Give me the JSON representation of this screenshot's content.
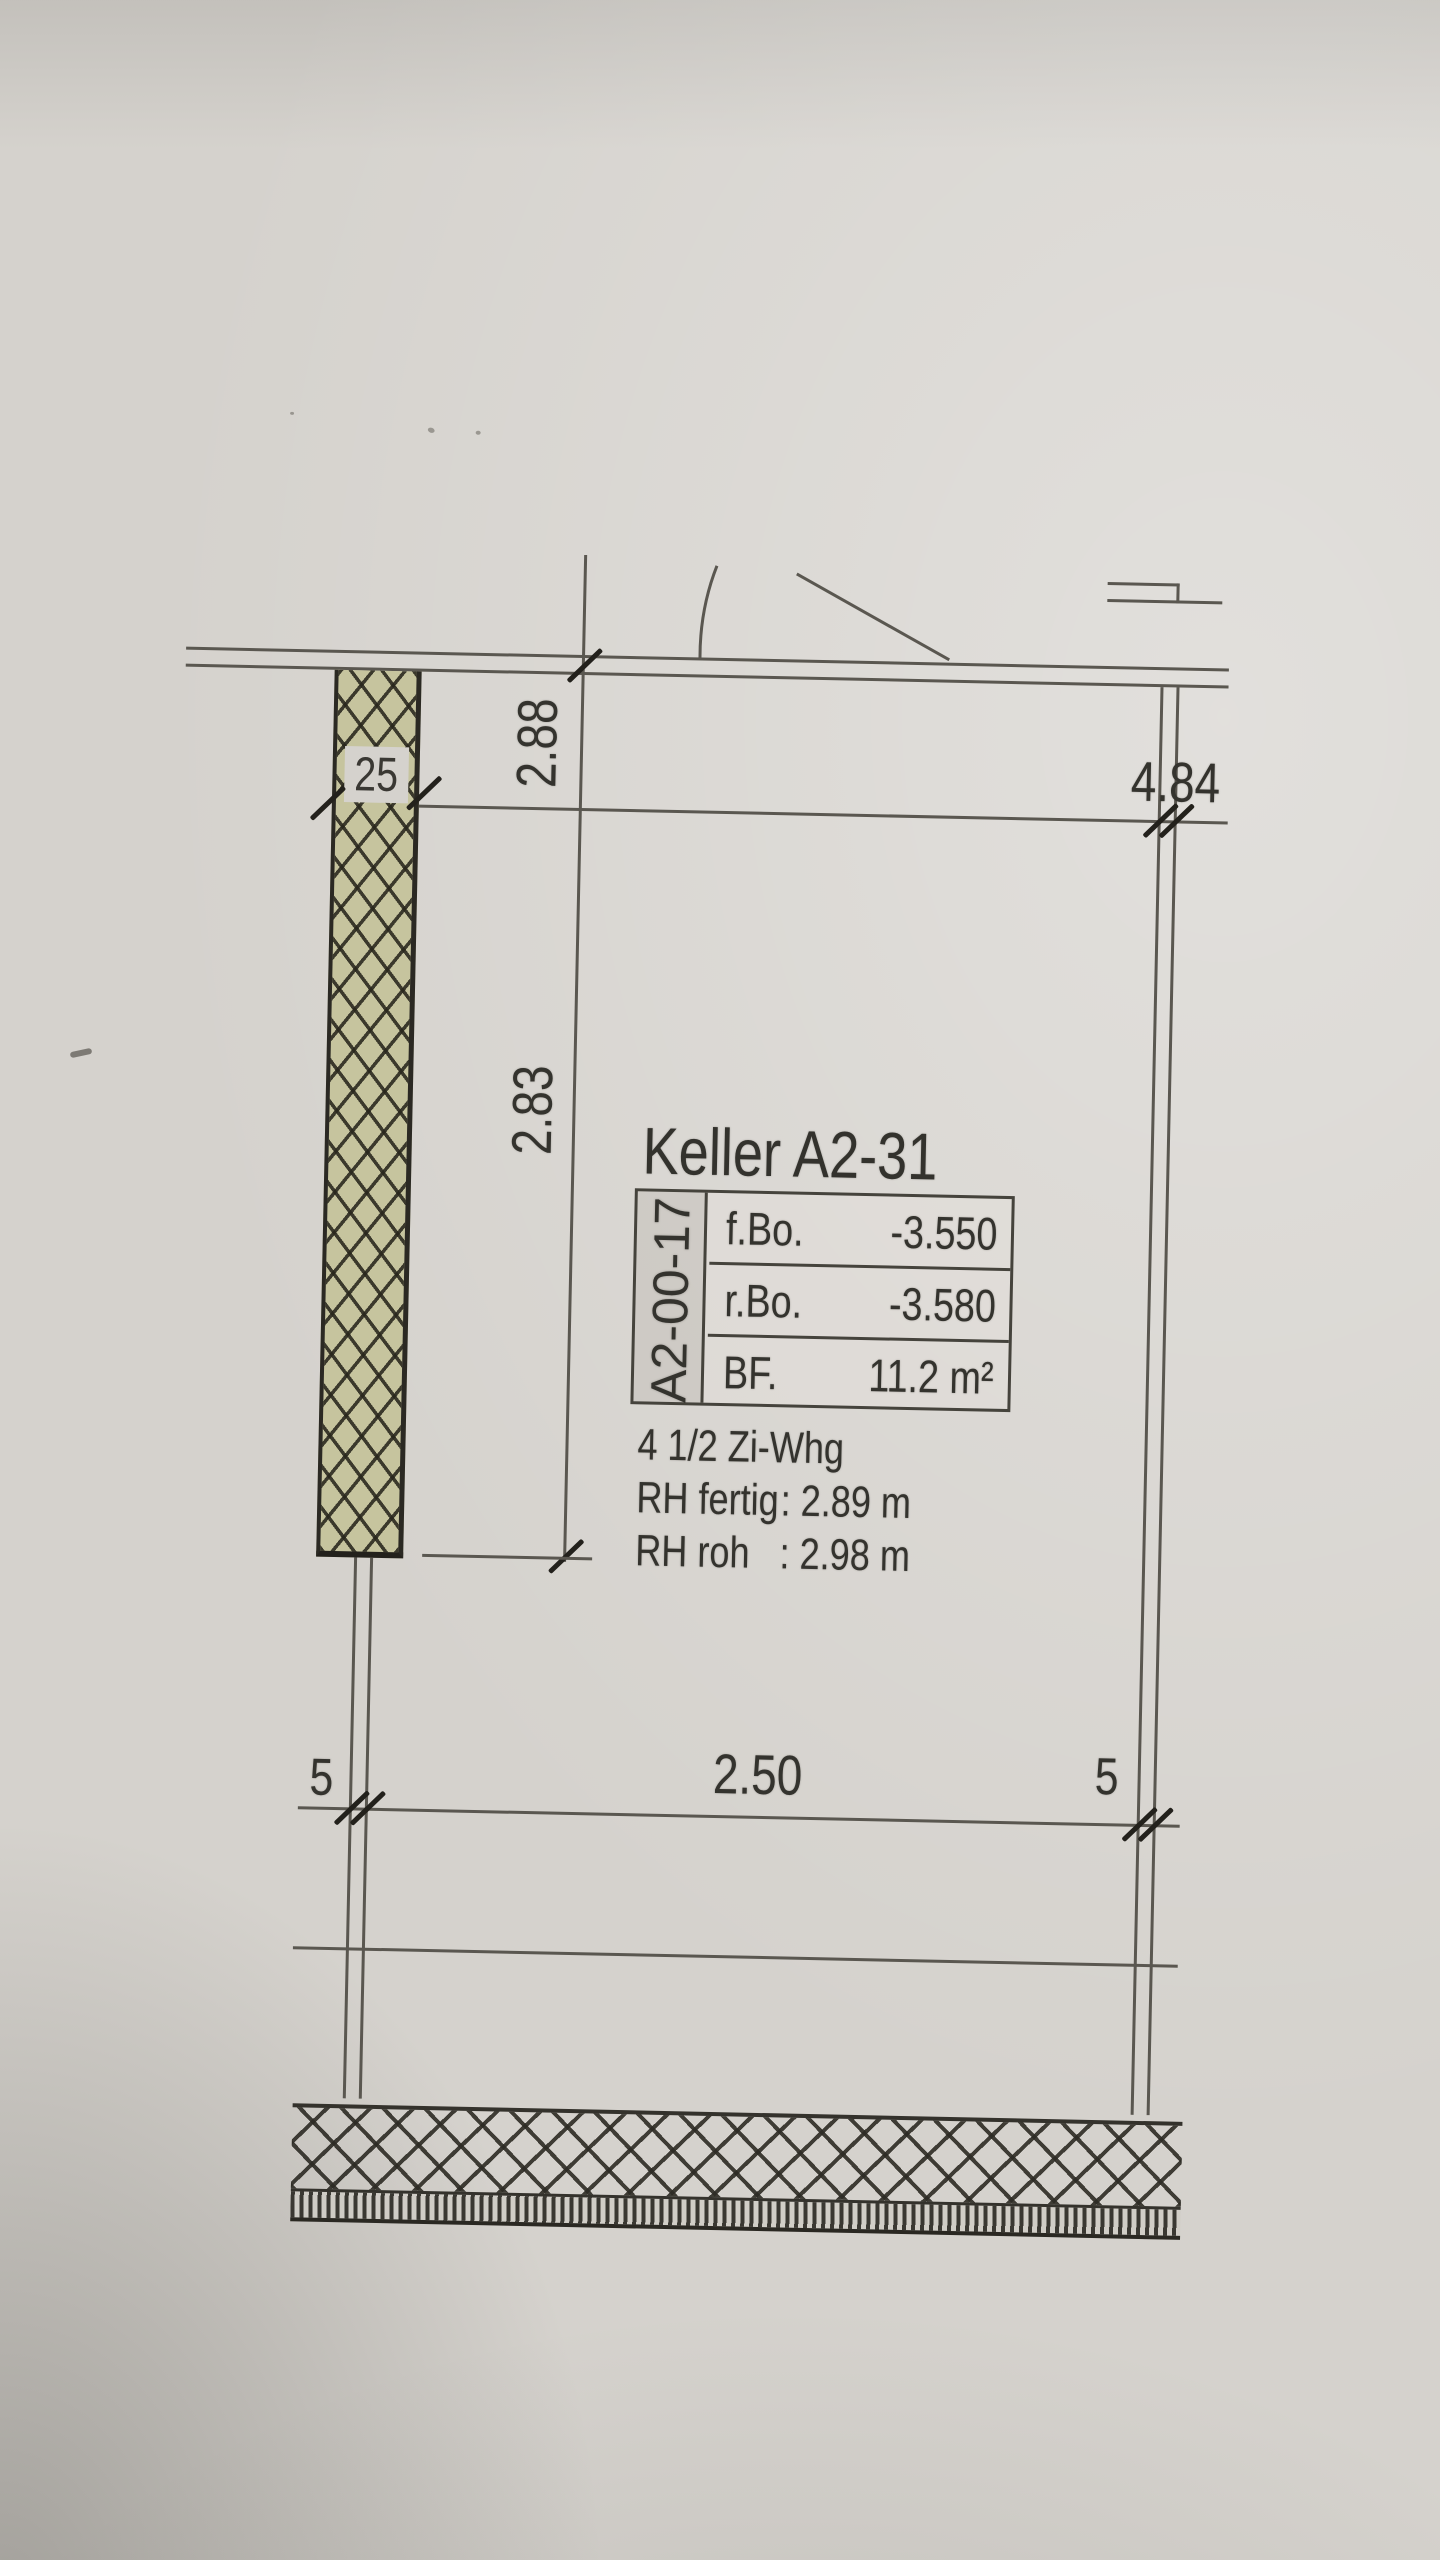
{
  "plan": {
    "title": "Keller A2-31",
    "info_table": {
      "room_id": "A2-00-17",
      "rows": [
        {
          "label": "f.Bo.",
          "value": "-3.550"
        },
        {
          "label": "r.Bo.",
          "value": "-3.580"
        },
        {
          "label": "BF.",
          "value": "11.2 m²"
        }
      ]
    },
    "notes": {
      "unit": "4 1/2 Zi-Whg",
      "rows": [
        {
          "label": "RH fertig",
          "value": ": 2.89 m"
        },
        {
          "label": "RH roh",
          "value": ": 2.98 m"
        }
      ]
    },
    "dimensions": {
      "upper_height": "2.88",
      "room_height": "2.83",
      "wall_thickness": "25",
      "top_width": "4.84",
      "bottom_width": "2.50",
      "bottom_wall_left": "5",
      "bottom_wall_right": "5"
    },
    "colors": {
      "paper": "#d5d2cd",
      "line": "#5a5750",
      "ink": "#34332e",
      "wall_fill": "#c6c49e"
    }
  }
}
